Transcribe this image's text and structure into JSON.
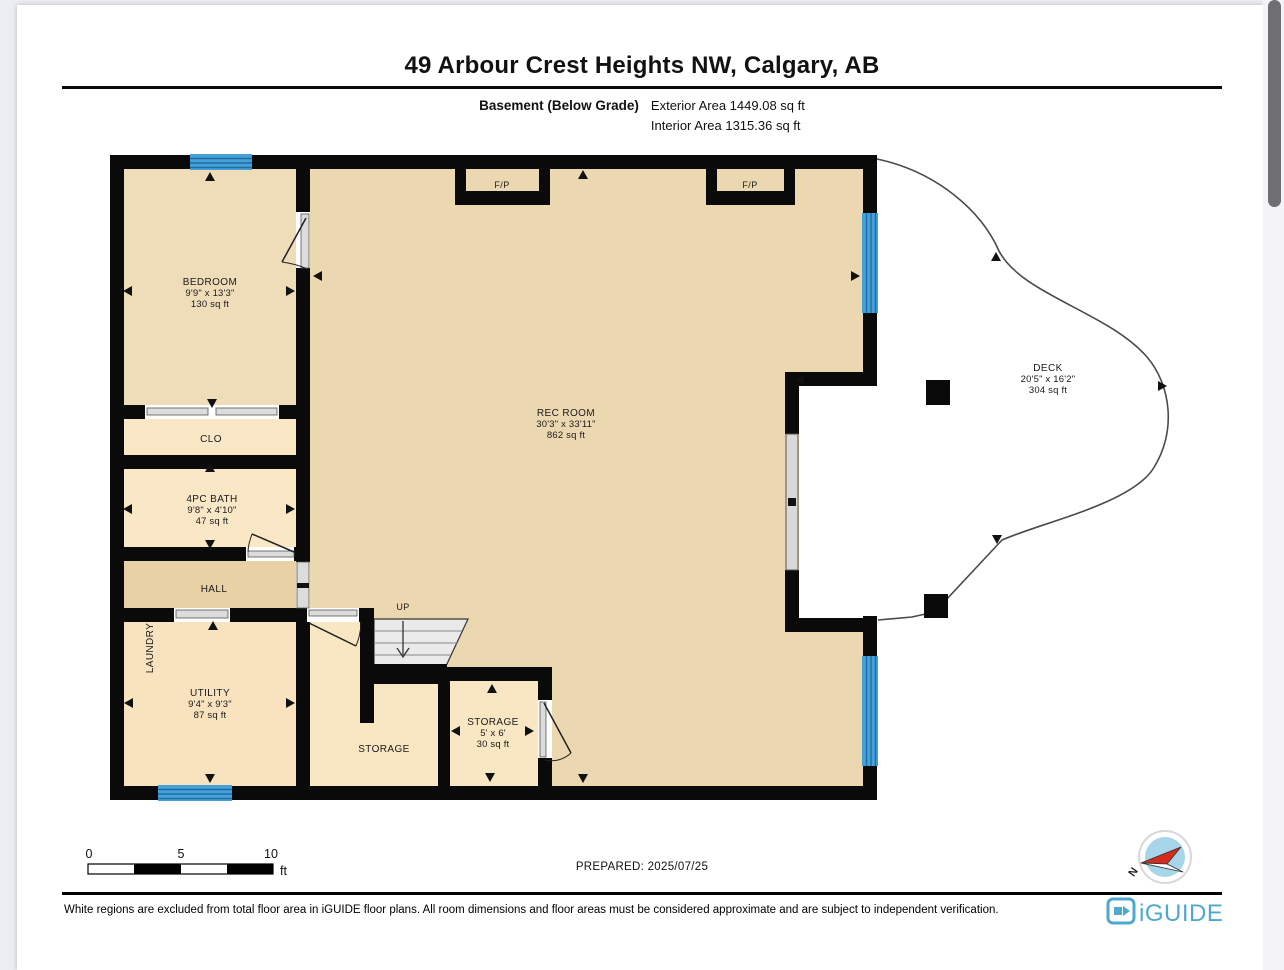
{
  "header": {
    "title": "49 Arbour Crest Heights NW, Calgary, AB",
    "floor_label": "Basement (Below Grade)",
    "exterior_area": "Exterior Area 1449.08 sq ft",
    "interior_area": "Interior Area 1315.36 sq ft"
  },
  "plan": {
    "rooms": {
      "bedroom": {
        "name": "BEDROOM",
        "dims": "9'9\" x 13'3\"",
        "area": "130 sq ft"
      },
      "clo": {
        "name": "CLO"
      },
      "bath": {
        "name": "4PC BATH",
        "dims": "9'8\" x 4'10\"",
        "area": "47 sq ft"
      },
      "hall": {
        "name": "HALL"
      },
      "laundry": {
        "name": "LAUNDRY"
      },
      "utility": {
        "name": "UTILITY",
        "dims": "9'4\" x 9'3\"",
        "area": "87 sq ft"
      },
      "storage_a": {
        "name": "STORAGE"
      },
      "storage_b": {
        "name": "STORAGE",
        "dims": "5' x 6'",
        "area": "30 sq ft"
      },
      "rec_room": {
        "name": "REC ROOM",
        "dims": "30'3\" x 33'11\"",
        "area": "862 sq ft"
      },
      "deck": {
        "name": "DECK",
        "dims": "20'5\" x 16'2\"",
        "area": "304 sq ft"
      }
    },
    "fp_label": "F/P",
    "up_label": "UP",
    "colors": {
      "wall": "#0a0a0a",
      "room_large": "#ECD8B0",
      "room_small": "#F9E6C3",
      "hall": "#E8D1A4",
      "utility": "#F8E3BE",
      "window": "#47A1D9",
      "window_line": "#1E6CA6",
      "stairs": "#EAEAEA",
      "opening": "#DCDCDC"
    }
  },
  "scale_bar": {
    "ticks": [
      "0",
      "5",
      "10"
    ],
    "unit": "ft"
  },
  "prepared": "PREPARED: 2025/07/25",
  "compass": {
    "north_label": "N"
  },
  "footer": {
    "disclaimer": "White regions are excluded from total floor area in iGUIDE floor plans. All room dimensions and floor areas must be considered approximate and are subject to independent verification.",
    "brand": "iGUIDE",
    "brand_color": "#4FA8CE"
  }
}
